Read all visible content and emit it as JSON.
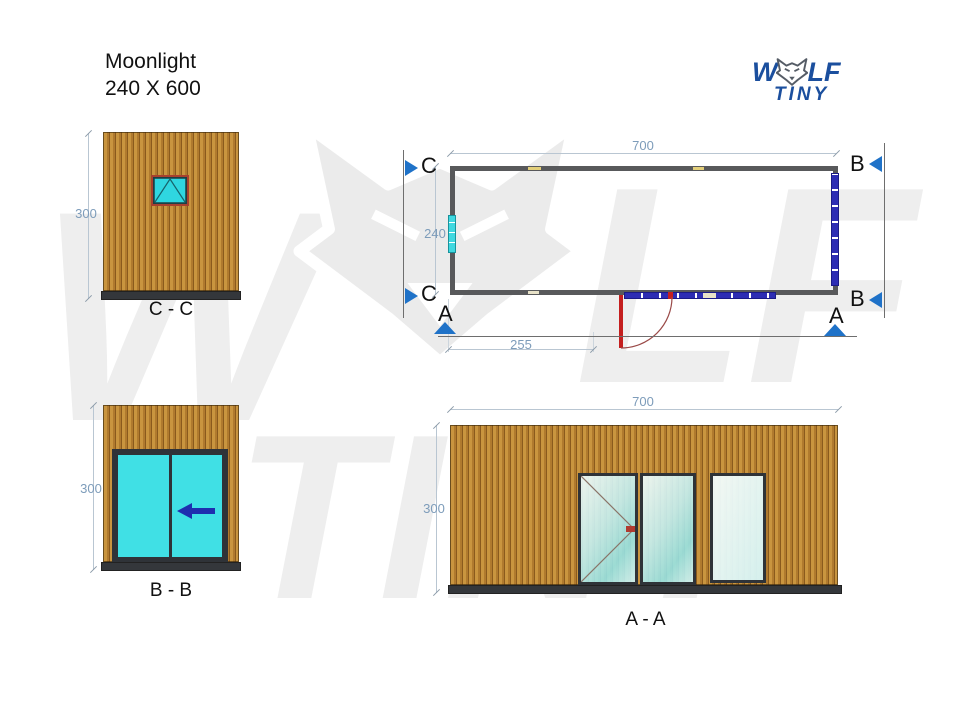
{
  "title": {
    "line1": "Moonlight",
    "line2": "240 X 600"
  },
  "logo": {
    "word_w": "W",
    "word_lf": "LF",
    "word_tiny": "TINY"
  },
  "plan": {
    "dim_width": "700",
    "dim_height": "240",
    "dim_door_offset": "255",
    "marker_c": "C",
    "marker_b": "B",
    "marker_a": "A"
  },
  "view_cc": {
    "label": "C - C",
    "dim_height": "300"
  },
  "view_bb": {
    "label": "B - B",
    "dim_height": "300"
  },
  "view_aa": {
    "label": "A - A",
    "dim_width": "700",
    "dim_height": "300"
  },
  "colors": {
    "section_triangle_blue": "#1f72c8",
    "dimension_text_blue": "#7d9cba",
    "logo_blue": "#1b4f9e",
    "wood_tan": "#c9953f",
    "glass_cyan": "#40e0e5",
    "plan_glazing_blue": "#2d2db4",
    "door_red": "#c41f1f",
    "wall_gray": "#58595b",
    "watermark_gray": "#ededed"
  }
}
